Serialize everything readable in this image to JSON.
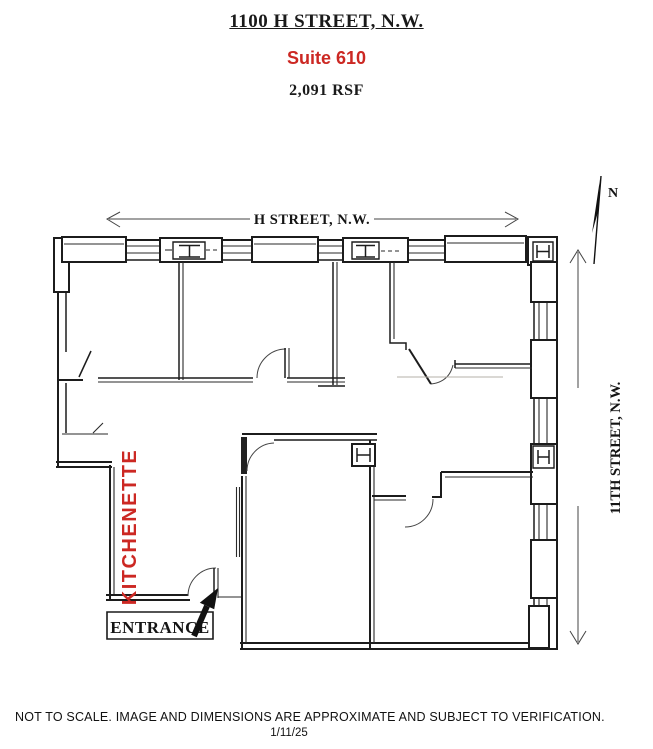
{
  "header": {
    "building": "1100 H STREET, N.W.",
    "suite": "Suite 610",
    "area": "2,091 RSF"
  },
  "plan": {
    "street_top": "H STREET, N.W.",
    "street_right": "11TH STREET, N.W.",
    "kitchenette_label": "KITCHENETTE",
    "entrance_label": "ENTRANCE",
    "compass_letter": "N"
  },
  "footer": {
    "disclaimer": "NOT TO SCALE. IMAGE AND DIMENSIONS ARE APPROXIMATE AND SUBJECT TO VERIFICATION.",
    "date": "1/11/25"
  },
  "colors": {
    "accent_red": "#cc2823",
    "ink": "#1a1a1a"
  }
}
